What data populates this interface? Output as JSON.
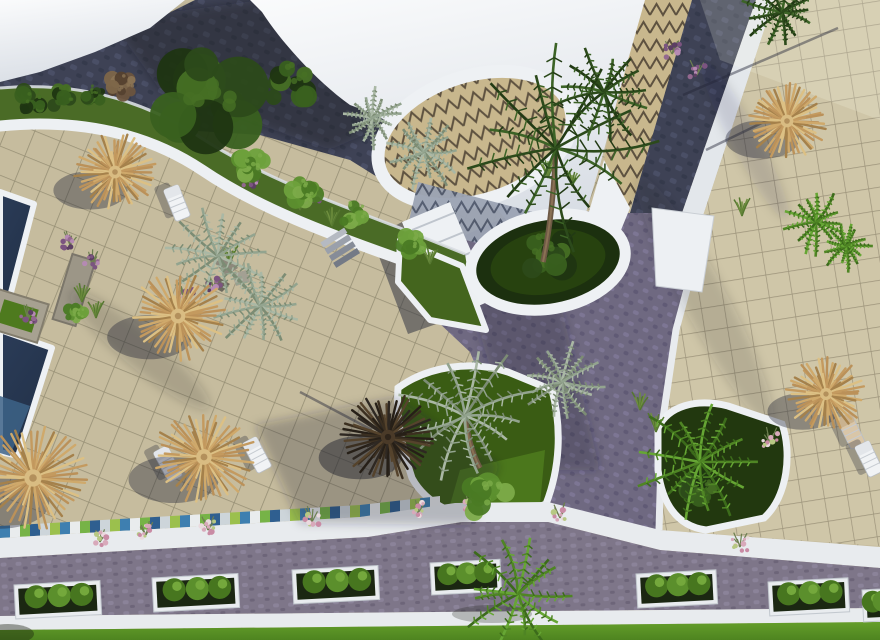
{
  "meta": {
    "description": "Aerial 3D architectural rendering of a resort complex: beige tiled sun terraces with straw parasols and white loungers, two navy swimming pools at the left edge, curved white-roofed buildings with zigzag-patterned domes at the top, dark cobblestone promenades crossing diagonally, landscaped garden beds with palm trees, a bottom road lined with white planter boxes and a bright green lawn strip."
  },
  "palette": {
    "tile_light": "#c6bc9e",
    "tile_right": "#cfc6a8",
    "grout": "#968f75",
    "cobble_dark": "#3e4255",
    "cobble_purple": "#6f6981",
    "cobble_road": "#7e7689",
    "white_structure": "#eef1f4",
    "pool_navy": "#26354e",
    "pool_light": "#3d6387",
    "straw": "#c9a566",
    "garden_grass": "#4a6b26",
    "bed_grass": "#3a5c14",
    "lawn": "#5a9420",
    "palm_dark": "#2c4a1b",
    "palm_silver": "#93a48f",
    "palm_bright": "#4f8524",
    "zigzag_tan": "#c8b78d",
    "zigzag_line": "#5e5240",
    "mosaic_blue": "#3e7fb0",
    "mosaic_green": "#76b347"
  },
  "scene": {
    "umbrellas": [
      {
        "x": 115,
        "y": 172,
        "r": 40,
        "variant": "straw"
      },
      {
        "x": 178,
        "y": 316,
        "r": 46,
        "variant": "straw"
      },
      {
        "x": 33,
        "y": 478,
        "r": 54,
        "variant": "straw"
      },
      {
        "x": 204,
        "y": 457,
        "r": 49,
        "variant": "straw"
      },
      {
        "x": 388,
        "y": 437,
        "r": 45,
        "variant": "dark"
      },
      {
        "x": 787,
        "y": 121,
        "r": 40,
        "variant": "straw"
      },
      {
        "x": 826,
        "y": 394,
        "r": 38,
        "variant": "straw"
      }
    ],
    "loungers": [
      {
        "x": 177,
        "y": 203,
        "rot": 68,
        "tone": "white"
      },
      {
        "x": 168,
        "y": 464,
        "rot": 62,
        "tone": "white"
      },
      {
        "x": 257,
        "y": 455,
        "rot": 62,
        "tone": "white"
      },
      {
        "x": 851,
        "y": 431,
        "rot": 64,
        "tone": "tan"
      },
      {
        "x": 869,
        "y": 459,
        "rot": 64,
        "tone": "white"
      }
    ],
    "palms": [
      {
        "x": 556,
        "y": 148,
        "r": 92,
        "variant": "dark",
        "trunk": [
          543,
          262
        ]
      },
      {
        "x": 604,
        "y": 92,
        "r": 46,
        "variant": "dark"
      },
      {
        "x": 782,
        "y": 12,
        "r": 36,
        "variant": "dark"
      },
      {
        "x": 465,
        "y": 416,
        "r": 66,
        "variant": "silver",
        "trunk": [
          480,
          468
        ]
      },
      {
        "x": 562,
        "y": 382,
        "r": 42,
        "variant": "silver"
      },
      {
        "x": 700,
        "y": 462,
        "r": 62,
        "variant": "bright"
      },
      {
        "x": 518,
        "y": 594,
        "r": 52,
        "variant": "bright"
      },
      {
        "x": 816,
        "y": 222,
        "r": 30,
        "variant": "bright"
      },
      {
        "x": 846,
        "y": 246,
        "r": 24,
        "variant": "bright"
      },
      {
        "x": 218,
        "y": 256,
        "r": 52,
        "variant": "silver"
      },
      {
        "x": 260,
        "y": 306,
        "r": 44,
        "variant": "silver"
      },
      {
        "x": 424,
        "y": 152,
        "r": 36,
        "variant": "silver"
      },
      {
        "x": 372,
        "y": 118,
        "r": 28,
        "variant": "silver"
      }
    ],
    "bushes": [
      {
        "x": 205,
        "y": 95,
        "r": 56,
        "variant": "dark"
      },
      {
        "x": 288,
        "y": 82,
        "r": 26,
        "variant": "dark"
      },
      {
        "x": 30,
        "y": 100,
        "r": 16,
        "variant": "dark"
      },
      {
        "x": 62,
        "y": 97,
        "r": 14,
        "variant": "dark"
      },
      {
        "x": 94,
        "y": 93,
        "r": 12,
        "variant": "dark"
      },
      {
        "x": 122,
        "y": 86,
        "r": 15,
        "variant": "dry"
      },
      {
        "x": 252,
        "y": 166,
        "r": 19,
        "variant": "light"
      },
      {
        "x": 304,
        "y": 192,
        "r": 17,
        "variant": "light"
      },
      {
        "x": 354,
        "y": 213,
        "r": 15,
        "variant": "light"
      },
      {
        "x": 412,
        "y": 244,
        "r": 16,
        "variant": "light"
      },
      {
        "x": 488,
        "y": 497,
        "r": 26,
        "variant": "light"
      },
      {
        "x": 543,
        "y": 252,
        "r": 28,
        "variant": "dark"
      },
      {
        "x": 700,
        "y": 487,
        "r": 18,
        "variant": "dark"
      },
      {
        "x": 76,
        "y": 314,
        "r": 11,
        "variant": "light"
      }
    ],
    "flowers": [
      {
        "x": 70,
        "y": 243,
        "c": "purple"
      },
      {
        "x": 92,
        "y": 263,
        "c": "purple"
      },
      {
        "x": 186,
        "y": 298,
        "c": "purple"
      },
      {
        "x": 214,
        "y": 287,
        "c": "purple"
      },
      {
        "x": 28,
        "y": 318,
        "c": "purple"
      },
      {
        "x": 250,
        "y": 182,
        "c": "purple"
      },
      {
        "x": 312,
        "y": 197,
        "c": "purple"
      },
      {
        "x": 672,
        "y": 52,
        "c": "purple"
      },
      {
        "x": 697,
        "y": 73,
        "c": "purple"
      },
      {
        "x": 100,
        "y": 540,
        "c": "pink"
      },
      {
        "x": 146,
        "y": 533,
        "c": "pink"
      },
      {
        "x": 208,
        "y": 528,
        "c": "pink"
      },
      {
        "x": 312,
        "y": 520,
        "c": "pink"
      },
      {
        "x": 418,
        "y": 511,
        "c": "pink"
      },
      {
        "x": 470,
        "y": 507,
        "c": "pink"
      },
      {
        "x": 560,
        "y": 516,
        "c": "pink"
      },
      {
        "x": 770,
        "y": 441,
        "c": "pink"
      },
      {
        "x": 740,
        "y": 545,
        "c": "pink"
      }
    ],
    "grass_tufts": [
      {
        "x": 96,
        "y": 316
      },
      {
        "x": 82,
        "y": 300
      },
      {
        "x": 230,
        "y": 262
      },
      {
        "x": 332,
        "y": 224
      },
      {
        "x": 548,
        "y": 176
      },
      {
        "x": 572,
        "y": 184
      },
      {
        "x": 742,
        "y": 214
      },
      {
        "x": 640,
        "y": 408
      },
      {
        "x": 656,
        "y": 430
      },
      {
        "x": 300,
        "y": 208
      },
      {
        "x": 430,
        "y": 262
      }
    ],
    "planter_boxes": [
      {
        "x": 14,
        "y": 585,
        "w": 86,
        "h": 34
      },
      {
        "x": 152,
        "y": 578,
        "w": 86,
        "h": 34
      },
      {
        "x": 292,
        "y": 570,
        "w": 86,
        "h": 34
      },
      {
        "x": 430,
        "y": 563,
        "w": 70,
        "h": 32
      },
      {
        "x": 636,
        "y": 574,
        "w": 80,
        "h": 34
      },
      {
        "x": 768,
        "y": 582,
        "w": 80,
        "h": 34
      },
      {
        "x": 862,
        "y": 590,
        "w": 40,
        "h": 32
      }
    ],
    "pole_shadows": [
      [
        683,
        95,
        838,
        28
      ],
      [
        706,
        150,
        772,
        118
      ],
      [
        300,
        392,
        372,
        430
      ]
    ]
  }
}
